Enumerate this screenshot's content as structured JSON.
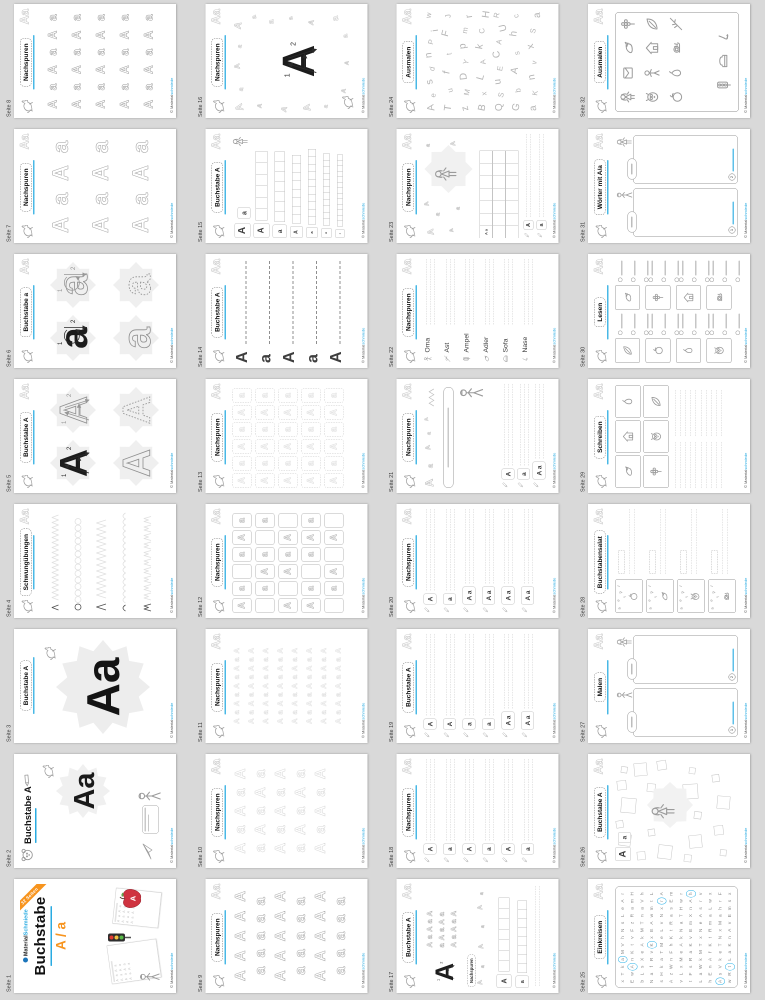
{
  "canvas": {
    "background": "#d9d9d9",
    "accent_cyan": "#29abe2",
    "accent_orange": "#f7941e"
  },
  "footer": {
    "prefix": "© Material",
    "suffix": "schmiede"
  },
  "header": {
    "badge": "Aa"
  },
  "cover": {
    "ribbon": "32 Seiten",
    "brand_black": "Material",
    "brand_cyan": "Schmiede",
    "title": "Buchstabe",
    "letters": "A / a"
  },
  "pages": [
    {
      "n": 1,
      "label": "Seite 1",
      "type": "cover",
      "title": "Buchstabe"
    },
    {
      "n": 2,
      "label": "Seite 2",
      "type": "cover2",
      "title": "Buchstabe A",
      "big": "Aa"
    },
    {
      "n": 3,
      "label": "Seite 3",
      "type": "poster",
      "title": "Buchstabe A",
      "big": "Aa"
    },
    {
      "n": 4,
      "label": "Seite 4",
      "type": "schwung",
      "title": "Schwungübungen"
    },
    {
      "n": 5,
      "label": "Seite 5",
      "type": "four",
      "title": "Buchstabe A",
      "letter": "A"
    },
    {
      "n": 6,
      "label": "Seite 6",
      "type": "four",
      "title": "Buchstabe a",
      "letter": "a"
    },
    {
      "n": 7,
      "label": "Seite 7",
      "type": "tgrid",
      "title": "Nachspuren",
      "cols": 4,
      "rows": 3,
      "fs": 44
    },
    {
      "n": 8,
      "label": "Seite 8",
      "type": "tgrid",
      "title": "Nachspuren",
      "cols": 6,
      "rows": 5,
      "fs": 24
    },
    {
      "n": 9,
      "label": "Seite 9",
      "type": "rowletters",
      "title": "Nachspuren",
      "rows": [
        "AAAAA",
        "aaaaa",
        "AAAAA",
        "aaaaa",
        "AAAAA",
        "aaaaa"
      ],
      "shade": "#a8a8a8",
      "fs": 30
    },
    {
      "n": 10,
      "label": "Seite 10",
      "type": "rowletters",
      "title": "Nachspuren",
      "rows": [
        "AaAaA",
        "aAaAa",
        "AaAaA",
        "aAaAa",
        "AaAaA"
      ],
      "shade": "#d8d8d8",
      "fs": 30
    },
    {
      "n": 11,
      "label": "Seite 11",
      "type": "rowletters",
      "title": "Nachspuren",
      "rows": [
        "AaAaAaAaA",
        "AaAaAaAaA",
        "AaAaAaAaA",
        "AaAaAaAaA",
        "AaAaAaAaA",
        "AaAaAaAaA",
        "AaAaAaAaA",
        "AaAaAaAaA"
      ],
      "shade": "#e2e2e2",
      "fs": 15
    },
    {
      "n": 12,
      "label": "Seite 12",
      "type": "boxgrid",
      "title": "Nachspuren",
      "style": "solid",
      "pattern": "110111011101101110110111011010"
    },
    {
      "n": 13,
      "label": "Seite 13",
      "type": "boxgrid",
      "title": "Nachspuren",
      "style": "dashed",
      "pattern": "111111111111111111111111111111"
    },
    {
      "n": 14,
      "label": "Seite 14",
      "type": "tracelines",
      "title": "Buchstabe A",
      "letters": [
        "A",
        "a",
        "A",
        "a",
        "A"
      ]
    },
    {
      "n": 15,
      "label": "Seite 15",
      "type": "sqrows",
      "title": "Buchstabe A",
      "samples": [
        "A",
        "a"
      ],
      "rowletters": [
        "A",
        "a",
        "A",
        "a",
        "A",
        "a"
      ]
    },
    {
      "n": 16,
      "label": "Seite 16",
      "type": "centerscatter",
      "title": "Nachspuren",
      "center": "A"
    },
    {
      "n": 17,
      "label": "Seite 17",
      "type": "mixed17",
      "title": "Buchstabe A",
      "subtitle": "Nachspuren",
      "rows": [
        "A a A a A",
        "a A a A a",
        "A a A a A"
      ],
      "rowletters": [
        "A",
        "a"
      ]
    },
    {
      "n": 18,
      "label": "Seite 18",
      "type": "writerows",
      "title": "Nachspuren",
      "rowletters": [
        "A",
        "a",
        "A",
        "a",
        "A",
        "a"
      ]
    },
    {
      "n": 19,
      "label": "Seite 19",
      "type": "writerows",
      "title": "Buchstabe A",
      "rowletters": [
        "A",
        "A",
        "a",
        "a",
        "A a",
        "A a"
      ]
    },
    {
      "n": 20,
      "label": "Seite 20",
      "type": "writerows",
      "title": "Nachspuren",
      "rowletters": [
        "A",
        "a",
        "A a",
        "A a",
        "A a",
        "A a"
      ]
    },
    {
      "n": 21,
      "label": "Seite 21",
      "type": "mixed21",
      "title": "Nachspuren",
      "rowletters": [
        "A",
        "a",
        "A a"
      ]
    },
    {
      "n": 22,
      "label": "Seite 22",
      "type": "wordrows",
      "title": "Nachspuren",
      "words": [
        "Oma",
        "Ast",
        "Ampel",
        "Adler",
        "Sofa",
        "Nase"
      ],
      "icons": [
        "person",
        "branch",
        "ampel",
        "bird",
        "sofa",
        "nose"
      ]
    },
    {
      "n": 23,
      "label": "Seite 23",
      "type": "mixed23",
      "title": "Nachspuren",
      "gridseed": "A a",
      "rowletters": [
        "A",
        "a"
      ]
    },
    {
      "n": 24,
      "label": "Seite 24",
      "type": "letterscatter",
      "title": "Ausmalen",
      "rows": [
        [
          "A",
          "e",
          "s",
          "d",
          "n",
          "P",
          "i",
          "w"
        ],
        [
          "T",
          "u",
          "f",
          "t",
          "F",
          "J"
        ],
        [
          "z",
          "M",
          "D",
          "Y",
          "p",
          "m",
          "r"
        ],
        [
          "B",
          "x",
          "L",
          "A",
          "k",
          "C",
          "H"
        ],
        [
          "Q",
          "S",
          "u",
          "E",
          "C",
          "A",
          "U",
          "R"
        ],
        [
          "G",
          "b",
          "A",
          "s",
          "h",
          "c"
        ],
        [
          "a",
          "K",
          "n",
          "v",
          "x",
          "S",
          "a"
        ]
      ]
    },
    {
      "n": 25,
      "label": "Seite 25",
      "type": "circlegrid",
      "title": "Einkreisen",
      "grid": [
        "xTkaMVhNsLeAr",
        "EwAnKtvFzRamH",
        "bLsXeAkMTnaVh",
        "NafRvKxEAwmtL",
        "sHkaTMeLvNxrA",
        "AzWnFhKtRasEm",
        "vLxMeAkNaTHwr",
        "tFsRaKvEmXnAh",
        "LaWkMTxNeAsrv",
        "hEnAfKtRmaLwx",
        "AsVkeTNxMahrF",
        "wRtLaKnAvEmsx"
      ],
      "circled": [
        3,
        15,
        44,
        63,
        103,
        130,
        145
      ]
    },
    {
      "n": 26,
      "label": "Seite 26",
      "type": "squarescatter",
      "title": "Buchstabe A",
      "samples": [
        "A",
        "a"
      ]
    },
    {
      "n": 27,
      "label": "Seite 27",
      "type": "panels",
      "title": "Malen",
      "numbers": [
        "1",
        "2"
      ]
    },
    {
      "n": 28,
      "label": "Seite 28",
      "type": "salat",
      "title": "Buchstabensalat",
      "items": [
        "apple",
        "bird",
        "owl",
        "snail"
      ],
      "letters": "aeplf"
    },
    {
      "n": 29,
      "label": "Seite 29",
      "type": "schreiben",
      "title": "Schreiben",
      "items": [
        "bird",
        "house",
        "pear",
        "flower",
        "owl",
        "leaf"
      ]
    },
    {
      "n": 30,
      "label": "Seite 30",
      "type": "lesen",
      "title": "Lesen",
      "items": [
        "leaf",
        "bird",
        "apple",
        "flower",
        "pear",
        "house",
        "owl",
        "snail"
      ]
    },
    {
      "n": 31,
      "label": "Seite 31",
      "type": "panels",
      "title": "Wörter mit A/a",
      "numbers": [
        "1",
        "2"
      ]
    },
    {
      "n": 32,
      "label": "Seite 32",
      "type": "framepics",
      "title": "Ausmalen",
      "items": [
        "girl",
        "card",
        "bird",
        "flower",
        "owl",
        "person",
        "house",
        "leaf",
        "apple",
        "pear",
        "snail",
        "branch",
        "ampel",
        "sofa",
        "nose"
      ]
    }
  ]
}
